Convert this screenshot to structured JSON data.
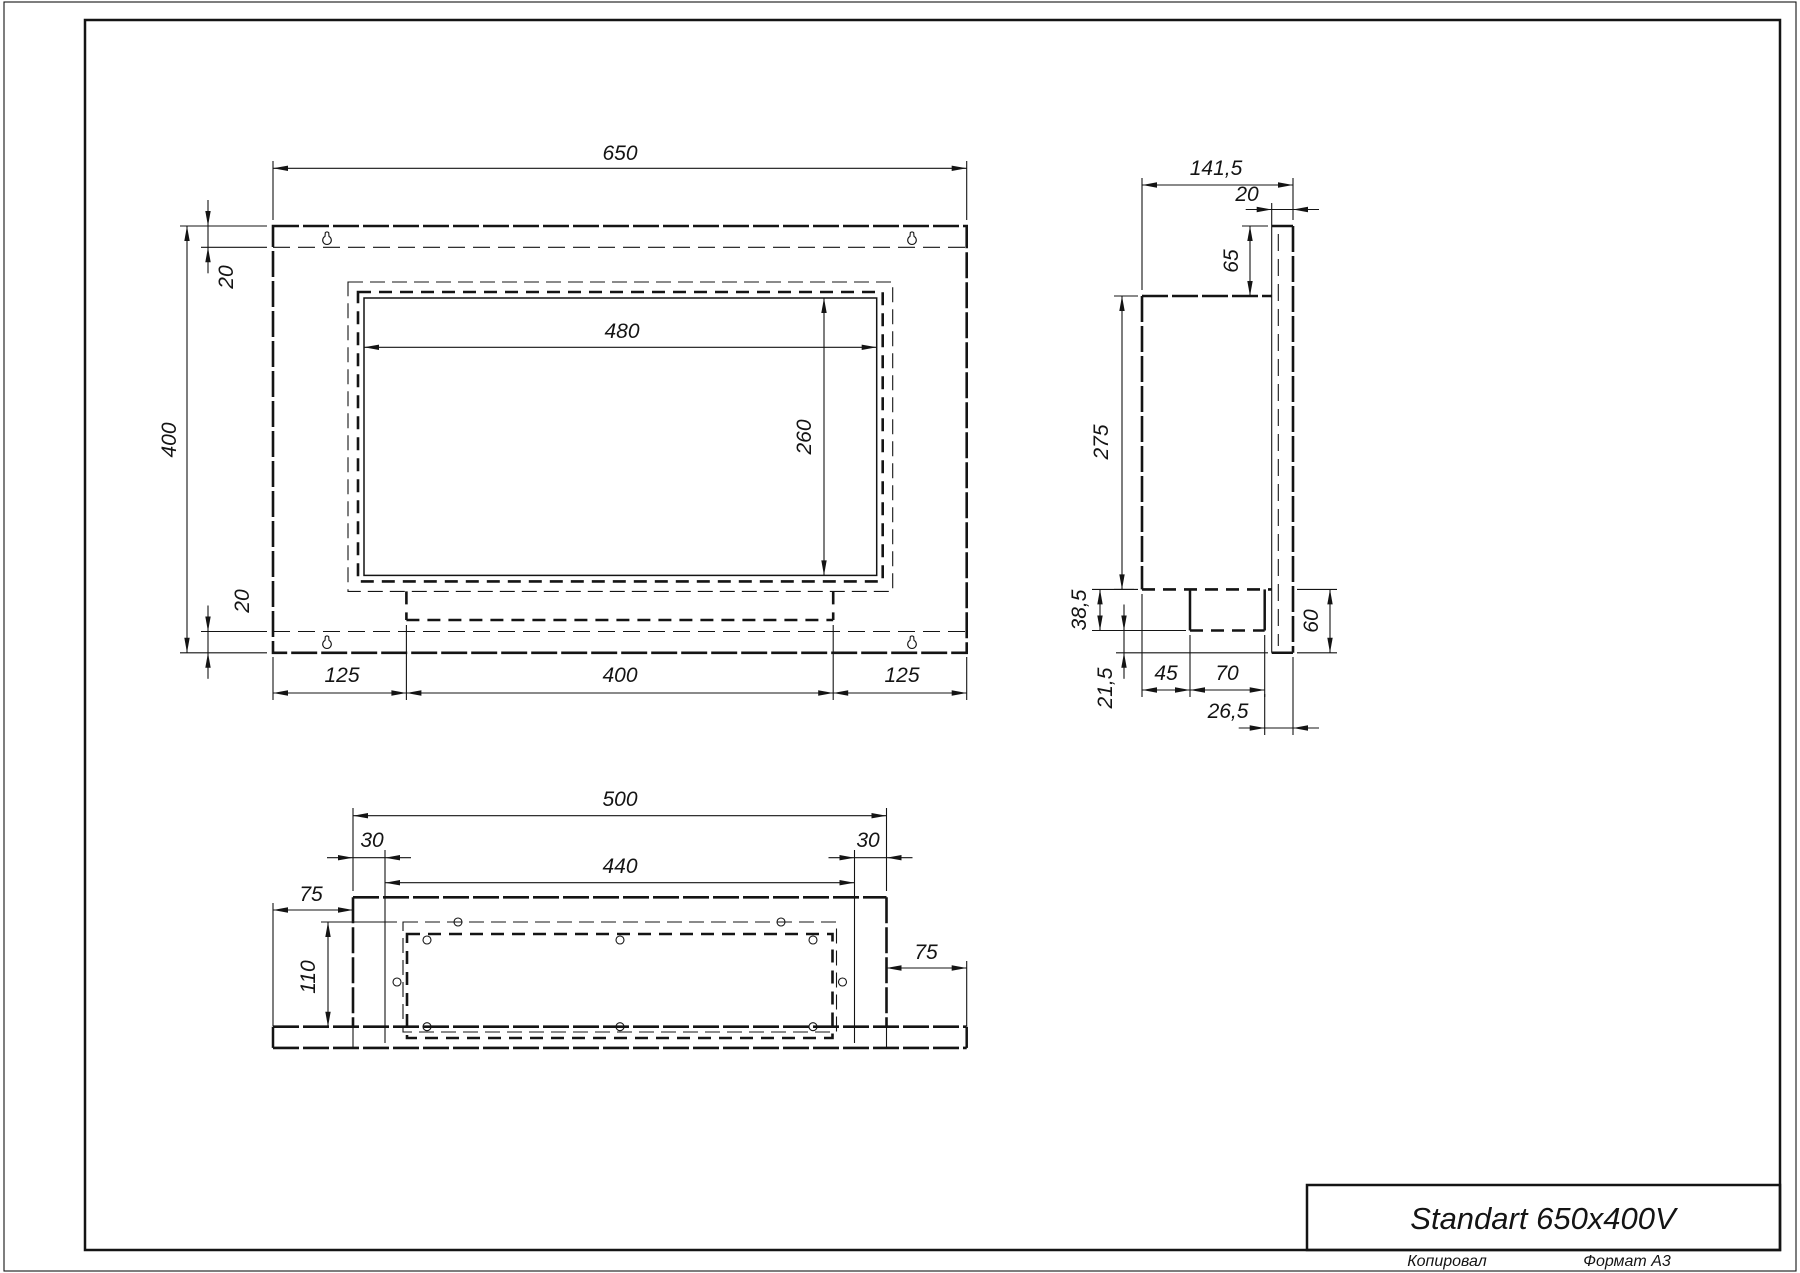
{
  "sheet": {
    "copied_label": "Копировал",
    "format_label": "Формат А3"
  },
  "title_block": {
    "title": "Standart 650x400V"
  },
  "views": {
    "front": {
      "name": "front-view",
      "dims": [
        {
          "id": "width",
          "label": "650"
        },
        {
          "id": "height",
          "label": "400"
        },
        {
          "id": "flange_top",
          "label": "20"
        },
        {
          "id": "flange_bottom",
          "label": "20"
        },
        {
          "id": "opening_width",
          "label": "480"
        },
        {
          "id": "opening_height",
          "label": "260"
        },
        {
          "id": "bottom_left",
          "label": "125"
        },
        {
          "id": "bottom_center",
          "label": "400"
        },
        {
          "id": "bottom_right",
          "label": "125"
        }
      ]
    },
    "side": {
      "name": "side-view",
      "dims": [
        {
          "id": "depth",
          "label": "141,5"
        },
        {
          "id": "flange_thickness",
          "label": "20"
        },
        {
          "id": "top_inset",
          "label": "65"
        },
        {
          "id": "body_height",
          "label": "275"
        },
        {
          "id": "burner_drop",
          "label": "38,5"
        },
        {
          "id": "flange_lip",
          "label": "21,5"
        },
        {
          "id": "burner_offset",
          "label": "45"
        },
        {
          "id": "burner_depth",
          "label": "70"
        },
        {
          "id": "front_gap",
          "label": "26,5"
        },
        {
          "id": "flange_below",
          "label": "60"
        }
      ]
    },
    "bottom": {
      "name": "bottom-view",
      "dims": [
        {
          "id": "box_width",
          "label": "500"
        },
        {
          "id": "inset_left",
          "label": "30"
        },
        {
          "id": "inner_width",
          "label": "440"
        },
        {
          "id": "inset_right",
          "label": "30"
        },
        {
          "id": "overhang_left",
          "label": "75"
        },
        {
          "id": "inner_depth",
          "label": "110"
        },
        {
          "id": "overhang_right",
          "label": "75"
        }
      ]
    }
  },
  "colors": {
    "line": "#141414",
    "background": "#ffffff"
  }
}
